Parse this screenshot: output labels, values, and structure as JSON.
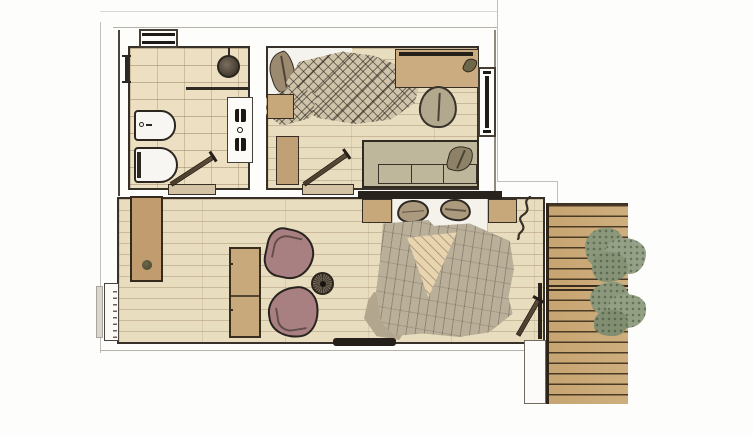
{
  "meta": {
    "type": "floor-plan",
    "style": "hand-drawn watercolor architectural sketch, top-down view",
    "text_visible": "none"
  },
  "palette": {
    "wall_outline": "#38312a",
    "tile_floor": "#ecdfc2",
    "wood_floor": "#e9ddc0",
    "deck_wood": "#c9a876",
    "armchair_mauve": "#a98082",
    "blanket_taupe": "#bab09a",
    "fold_cream": "#e8d5af",
    "shrub_green": "#8c987c",
    "fixture_white": "#f7f6f2",
    "door_leaf_brown": "#53422f"
  },
  "rooms": [
    {
      "id": "bathroom",
      "floor": "tile",
      "fixtures": [
        "towel-rail",
        "shower-head",
        "shower-screen",
        "bidet",
        "toilet",
        "double-vanity",
        "door-swing"
      ]
    },
    {
      "id": "bedroom-top",
      "floor": "wood-plank",
      "furniture": [
        "bed-with-rumpled-quilt",
        "white-sheet",
        "plant-leaf",
        "nightstand",
        "dresser",
        "desk-with-shelf",
        "desk-plant",
        "desk-chair",
        "daybed-with-cushions",
        "daybed-plant",
        "door-swing"
      ]
    },
    {
      "id": "living-bedroom",
      "floor": "wood-plank",
      "furniture": [
        "sideboard-with-plant",
        "console-table",
        "armchair",
        "armchair",
        "round-side-table",
        "double-bed-mattress",
        "pillow",
        "pillow",
        "nightstand-left",
        "nightstand-right",
        "duvet-with-folded-corner",
        "duvet-flap",
        "wall-plant-squiggle",
        "media-bar",
        "deck-door-swing"
      ]
    },
    {
      "id": "terrace-deck",
      "floor": "deck-planks",
      "features": [
        "plank-band-divider",
        "shrub-cluster-upper",
        "shrub-cluster-lower",
        "white-pillar"
      ]
    }
  ],
  "openings": {
    "windows": [
      "top-wall-window",
      "bedroom-right-window",
      "living-left-window"
    ],
    "doors": [
      "bathroom-door",
      "bedroom-door",
      "deck-door"
    ]
  }
}
